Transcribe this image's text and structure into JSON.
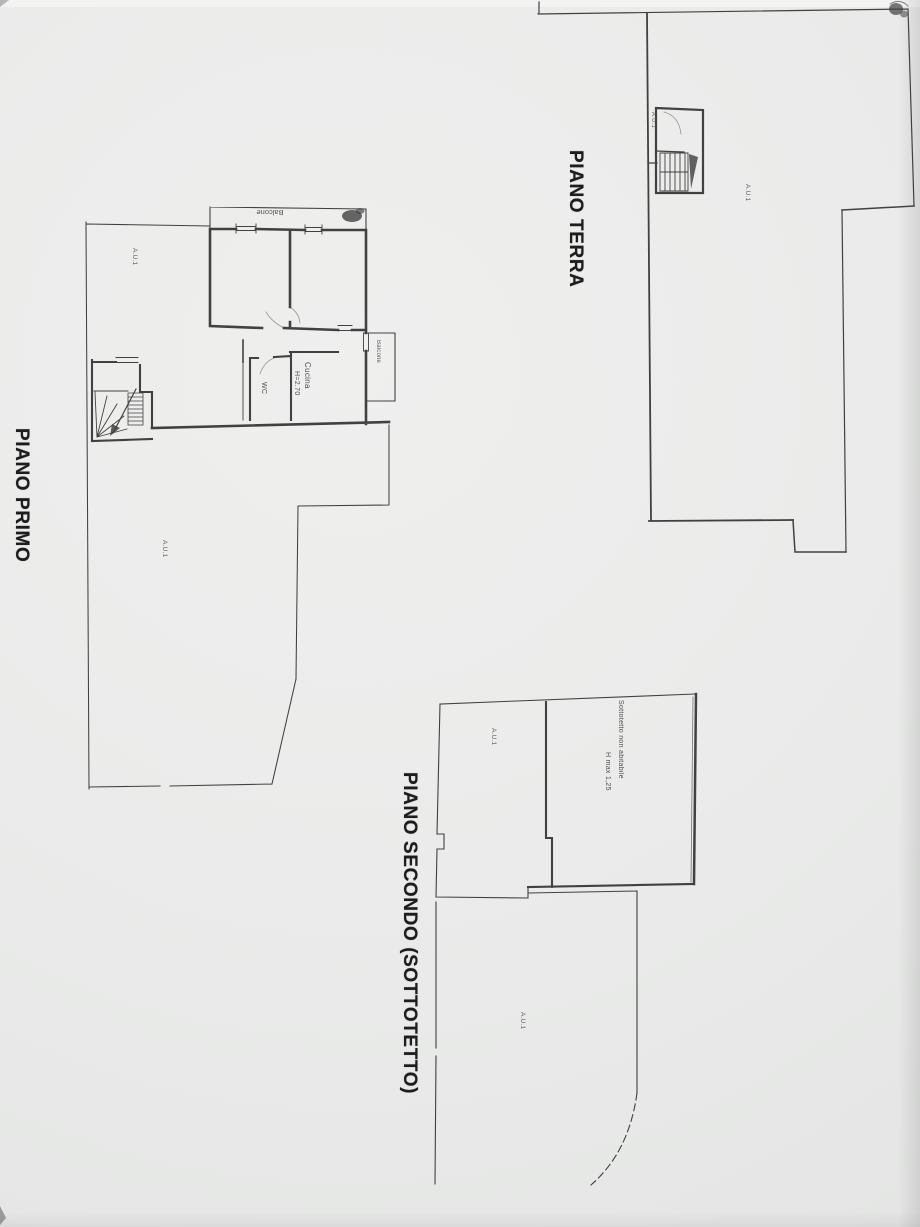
{
  "colors": {
    "ink": "#383838",
    "paper": "#e9eae9"
  },
  "floors": {
    "terra": {
      "title": "PIANO TERRA",
      "labels": {
        "stair_unit": "A.U.1",
        "main_area": "A.U.1"
      }
    },
    "primo": {
      "title": "PIANO PRIMO",
      "labels": {
        "room_top_left": "A.U.1",
        "balcony_top": "Balcone",
        "balcony_right": "Balcone",
        "wc": "WC",
        "kitchen": "Cucina",
        "kitchen_height": "H=2.70",
        "courtyard": "A.U.1"
      }
    },
    "secondo": {
      "title": "PIANO SECONDO (SOTTOTETTO)",
      "labels": {
        "left_area": "A.U.1",
        "attic": "Sottotetto non abitabile",
        "attic_height": "H max 1,25",
        "lower_area": "A.U.1"
      }
    }
  }
}
